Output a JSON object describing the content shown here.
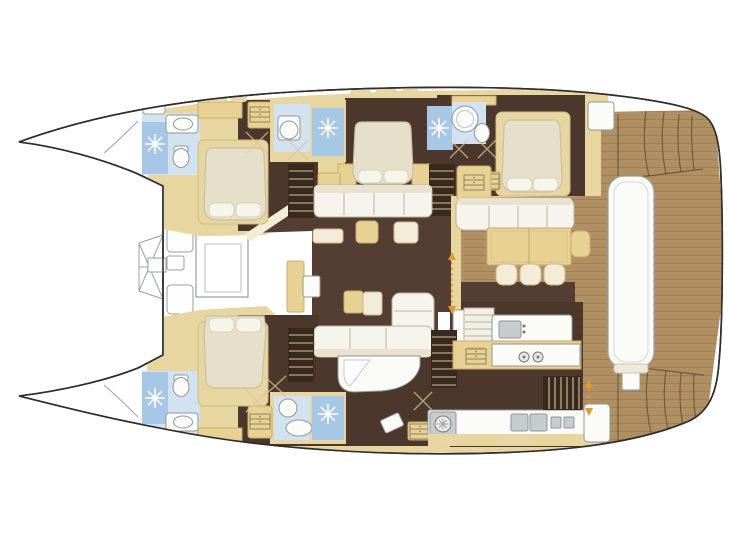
{
  "meta": {
    "type": "yacht-deck-plan",
    "vessel": "sailing-catamaran",
    "view": "overhead-accommodation-layout",
    "label": "Catamaran interior deck plan with three guest cabins, four bathrooms, salon, galley and aft cockpit"
  },
  "palette": {
    "bg": "#ffffff",
    "outline": "#2e2e2e",
    "structure": "#e8d6a0",
    "tanFurniture": "#e7d193",
    "cream": "#f2ecd8",
    "sofaWhite": "#f6f4ec",
    "sofaTrim": "#b9b4a4",
    "bedCream": "#e6dfc9",
    "bedStroke": "#c9bfa5",
    "pillow": "#f7f4ea",
    "floorDark": "#543e33",
    "floorHull": "#4c372d",
    "wood": "#b08f63",
    "woodLine": "#8a6b45",
    "blueTile": "#a6c7e5",
    "blueLight": "#d3e2f1",
    "fixWhite": "#fbfbf8",
    "fixGrey": "#c6cbcd",
    "fixStroke": "#8f979b",
    "stairDark": "#38291f",
    "tread": "#d9c28f",
    "arrow": "#e09a30",
    "benchStroke": "#9aa0a6",
    "glass": "#f3ecd7",
    "windowDash": "#e6d6a8"
  },
  "rooms": [
    "starboard-forward-bathroom",
    "starboard-forward-cabin",
    "starboard-mid-bathroom",
    "starboard-mid-cabin",
    "starboard-aft-bathroom",
    "starboard-aft-cabin",
    "port-forward-bathroom",
    "port-forward-cabin",
    "port-mid-bathroom",
    "port-bathtub-room",
    "galley",
    "salon",
    "aft-cockpit",
    "foredeck",
    "stern-platform"
  ],
  "fixtures": [
    "shower-rose-icon",
    "sink-icon",
    "toilet-icon",
    "bathtub-icon",
    "burner-icon",
    "washing-machine-icon",
    "drawer-cabinet-icon",
    "companionway-arrow-icon",
    "door-swing-icon",
    "deck-hatch-icon",
    "skylight-icon",
    "stair-icon"
  ]
}
